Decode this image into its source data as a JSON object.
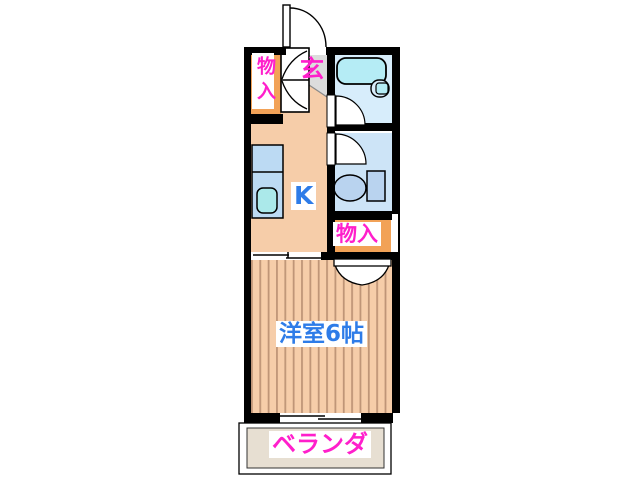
{
  "labels": {
    "closet_top": "物入",
    "entrance": "玄",
    "kitchen": "K",
    "closet_side": "物入",
    "main_room": "洋室6帖",
    "veranda": "ベランダ"
  },
  "colors": {
    "wall": "#000000",
    "kitchen_floor": "#f6cda9",
    "room_floor": "#f6cda9",
    "room_stripe": "#bf9577",
    "closet_fill": "#f2a257",
    "entrance_floor": "#dcdcdc",
    "bath_floor": "#d7edfb",
    "toilet_floor": "#cde4f7",
    "bathtub": "#b5ecf5",
    "fixture_blue": "#b9d3ef",
    "counter": "#bcdaf3",
    "sink": "#abe9ea",
    "veranda_floor": "#e7dfd2",
    "door_white": "#ffffff",
    "label_bg": "#ffffff",
    "label_magenta": "#ff1fcb",
    "label_blue": "#2e7ce8"
  }
}
